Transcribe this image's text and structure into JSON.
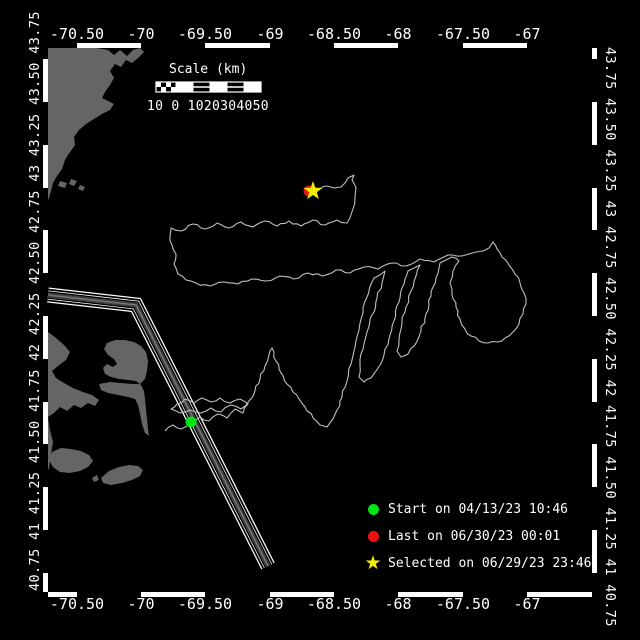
{
  "canvas": {
    "width": 640,
    "height": 640,
    "background": "#000000"
  },
  "axes": {
    "lon_labels": [
      "-70.50",
      "-70",
      "-69.50",
      "-69",
      "-68.50",
      "-68",
      "-67.50",
      "-67"
    ],
    "lon_tick_x": [
      77,
      141,
      205,
      270,
      334,
      398,
      463,
      527
    ],
    "lat_tick_y": [
      59,
      102,
      145,
      188,
      230,
      273,
      316,
      359,
      402,
      444,
      487,
      530,
      573
    ],
    "lat_left_text": "40.75 41 41.25 41.50 41.75 42 42.25 42.50 42.75 43 43.25 43.50 43.75",
    "lat_right_text": "43.75 43.50 43.25 43 42.75 42.50 42.25 42 41.75 41.50 41.25 41 40.75",
    "frame": {
      "left": 48,
      "top": 48,
      "right": 592,
      "bottom": 592,
      "band": 5,
      "color": "#ffffff"
    }
  },
  "scalebar": {
    "title": "Scale (km)",
    "tick_text": "10 0 1020304050",
    "x": 156,
    "y": 82,
    "width": 105,
    "height": 10,
    "check_cols": 4,
    "check_rows": 2,
    "cells": 5
  },
  "legend": {
    "items": [
      {
        "marker": "circle",
        "color": "#00e412",
        "label": "Start on 04/13/23 10:46"
      },
      {
        "marker": "circle",
        "color": "#ee1111",
        "label": "Last on 06/30/23 00:01"
      },
      {
        "marker": "star",
        "color": "#f5ef00",
        "glyph": "★",
        "label": "Selected on 06/29/23 23:46"
      }
    ]
  },
  "map_data": {
    "colors": {
      "land": "#656565",
      "track": "#bfbfbf",
      "frame": "#ffffff",
      "lane_edge": "#ffffff",
      "lane_core": "#3f3f3f",
      "lane_center": "#757575",
      "start": "#00e412",
      "last": "#ee1111",
      "selected": "#f5ef00"
    },
    "markers": {
      "start": {
        "x": 191,
        "y": 422,
        "r": 5.5
      },
      "last": {
        "x": 309,
        "y": 191,
        "r": 5.5
      },
      "selected": {
        "x": 313,
        "y": 191,
        "r_outer": 10,
        "r_inner": 4
      }
    },
    "lane": [
      [
        48,
        295
      ],
      [
        136,
        305
      ],
      [
        268,
        566
      ]
    ],
    "land": [
      [
        [
          48,
          48
        ],
        [
          96,
          48
        ],
        [
          108,
          50
        ],
        [
          114,
          55
        ],
        [
          120,
          50
        ],
        [
          127,
          56
        ],
        [
          133,
          50
        ],
        [
          140,
          48
        ],
        [
          144,
          52
        ],
        [
          138,
          58
        ],
        [
          132,
          63
        ],
        [
          126,
          60
        ],
        [
          121,
          67
        ],
        [
          115,
          64
        ],
        [
          110,
          71
        ],
        [
          114,
          78
        ],
        [
          110,
          85
        ],
        [
          105,
          92
        ],
        [
          102,
          98
        ],
        [
          108,
          101
        ],
        [
          114,
          104
        ],
        [
          110,
          110
        ],
        [
          102,
          114
        ],
        [
          94,
          119
        ],
        [
          86,
          124
        ],
        [
          79,
          130
        ],
        [
          74,
          137
        ],
        [
          75,
          145
        ],
        [
          70,
          152
        ],
        [
          65,
          160
        ],
        [
          62,
          169
        ],
        [
          57,
          176
        ],
        [
          53,
          183
        ],
        [
          51,
          191
        ],
        [
          49,
          198
        ],
        [
          48,
          200
        ]
      ],
      [
        [
          60,
          181
        ],
        [
          67,
          183
        ],
        [
          65,
          188
        ],
        [
          58,
          186
        ]
      ],
      [
        [
          71,
          179
        ],
        [
          77,
          181
        ],
        [
          74,
          186
        ],
        [
          69,
          184
        ]
      ],
      [
        [
          80,
          185
        ],
        [
          85,
          187
        ],
        [
          83,
          191
        ],
        [
          78,
          189
        ]
      ],
      [
        [
          48,
          332
        ],
        [
          56,
          338
        ],
        [
          64,
          345
        ],
        [
          70,
          352
        ],
        [
          66,
          360
        ],
        [
          58,
          366
        ],
        [
          52,
          371
        ],
        [
          56,
          378
        ],
        [
          64,
          383
        ],
        [
          73,
          388
        ],
        [
          83,
          392
        ],
        [
          92,
          395
        ],
        [
          99,
          400
        ],
        [
          95,
          406
        ],
        [
          88,
          403
        ],
        [
          81,
          408
        ],
        [
          74,
          405
        ],
        [
          67,
          411
        ],
        [
          60,
          407
        ],
        [
          54,
          413
        ],
        [
          48,
          417
        ],
        [
          50,
          430
        ],
        [
          53,
          442
        ],
        [
          51,
          455
        ],
        [
          49,
          468
        ],
        [
          48,
          470
        ]
      ],
      [
        [
          99,
          384
        ],
        [
          110,
          382
        ],
        [
          121,
          383
        ],
        [
          132,
          384
        ],
        [
          140,
          384
        ],
        [
          145,
          379
        ],
        [
          147,
          371
        ],
        [
          148,
          361
        ],
        [
          146,
          352
        ],
        [
          141,
          346
        ],
        [
          134,
          342
        ],
        [
          125,
          340
        ],
        [
          115,
          340
        ],
        [
          107,
          343
        ],
        [
          104,
          349
        ],
        [
          108,
          355
        ],
        [
          114,
          359
        ],
        [
          117,
          364
        ],
        [
          113,
          367
        ],
        [
          107,
          364
        ],
        [
          103,
          368
        ],
        [
          105,
          374
        ],
        [
          111,
          377
        ],
        [
          119,
          379
        ],
        [
          128,
          380
        ],
        [
          136,
          381
        ],
        [
          141,
          385
        ],
        [
          144,
          391
        ],
        [
          145,
          399
        ],
        [
          146,
          409
        ],
        [
          147,
          419
        ],
        [
          148,
          429
        ],
        [
          149,
          436
        ],
        [
          145,
          433
        ],
        [
          142,
          424
        ],
        [
          140,
          414
        ],
        [
          138,
          405
        ],
        [
          135,
          399
        ],
        [
          128,
          397
        ],
        [
          118,
          395
        ],
        [
          108,
          393
        ],
        [
          101,
          390
        ]
      ],
      [
        [
          52,
          452
        ],
        [
          61,
          448
        ],
        [
          71,
          449
        ],
        [
          81,
          451
        ],
        [
          89,
          455
        ],
        [
          93,
          461
        ],
        [
          88,
          467
        ],
        [
          80,
          471
        ],
        [
          70,
          473
        ],
        [
          60,
          472
        ],
        [
          53,
          467
        ],
        [
          49,
          460
        ]
      ],
      [
        [
          101,
          478
        ],
        [
          109,
          471
        ],
        [
          119,
          467
        ],
        [
          129,
          465
        ],
        [
          138,
          466
        ],
        [
          143,
          470
        ],
        [
          140,
          476
        ],
        [
          132,
          480
        ],
        [
          122,
          483
        ],
        [
          111,
          485
        ],
        [
          103,
          483
        ]
      ],
      [
        [
          92,
          478
        ],
        [
          97,
          475
        ],
        [
          99,
          480
        ],
        [
          94,
          482
        ]
      ]
    ],
    "track": [
      [
        165,
        431
      ],
      [
        173,
        425
      ],
      [
        181,
        429
      ],
      [
        191,
        422
      ],
      [
        200,
        417
      ],
      [
        209,
        421
      ],
      [
        218,
        414
      ],
      [
        227,
        418
      ],
      [
        235,
        409
      ],
      [
        243,
        413
      ],
      [
        248,
        404
      ],
      [
        240,
        399
      ],
      [
        230,
        403
      ],
      [
        220,
        398
      ],
      [
        211,
        402
      ],
      [
        202,
        398
      ],
      [
        194,
        403
      ],
      [
        185,
        399
      ],
      [
        177,
        404
      ],
      [
        171,
        409
      ],
      [
        180,
        413
      ],
      [
        190,
        410
      ],
      [
        201,
        413
      ],
      [
        211,
        408
      ],
      [
        221,
        412
      ],
      [
        231,
        405
      ],
      [
        241,
        409
      ],
      [
        249,
        401
      ],
      [
        255,
        391
      ],
      [
        260,
        379
      ],
      [
        265,
        366
      ],
      [
        269,
        355
      ],
      [
        272,
        348
      ],
      [
        276,
        361
      ],
      [
        281,
        373
      ],
      [
        287,
        384
      ],
      [
        293,
        392
      ],
      [
        299,
        399
      ],
      [
        305,
        407
      ],
      [
        313,
        418
      ],
      [
        320,
        425
      ],
      [
        327,
        427
      ],
      [
        333,
        419
      ],
      [
        337,
        410
      ],
      [
        342,
        397
      ],
      [
        347,
        381
      ],
      [
        351,
        364
      ],
      [
        355,
        347
      ],
      [
        359,
        330
      ],
      [
        363,
        313
      ],
      [
        367,
        297
      ],
      [
        371,
        284
      ],
      [
        374,
        278
      ],
      [
        380,
        275
      ],
      [
        385,
        271
      ],
      [
        382,
        283
      ],
      [
        377,
        298
      ],
      [
        372,
        315
      ],
      [
        367,
        332
      ],
      [
        363,
        349
      ],
      [
        360,
        365
      ],
      [
        359,
        377
      ],
      [
        364,
        382
      ],
      [
        371,
        378
      ],
      [
        378,
        368
      ],
      [
        384,
        355
      ],
      [
        389,
        339
      ],
      [
        394,
        321
      ],
      [
        399,
        302
      ],
      [
        404,
        284
      ],
      [
        408,
        271
      ],
      [
        414,
        268
      ],
      [
        420,
        265
      ],
      [
        416,
        276
      ],
      [
        411,
        291
      ],
      [
        406,
        307
      ],
      [
        402,
        323
      ],
      [
        399,
        339
      ],
      [
        397,
        351
      ],
      [
        401,
        357
      ],
      [
        408,
        354
      ],
      [
        415,
        345
      ],
      [
        421,
        331
      ],
      [
        426,
        314
      ],
      [
        431,
        296
      ],
      [
        436,
        278
      ],
      [
        440,
        263
      ],
      [
        446,
        260
      ],
      [
        452,
        257
      ],
      [
        459,
        261
      ],
      [
        453,
        271
      ],
      [
        450,
        283
      ],
      [
        452,
        295
      ],
      [
        456,
        307
      ],
      [
        460,
        319
      ],
      [
        465,
        329
      ],
      [
        471,
        336
      ],
      [
        479,
        341
      ],
      [
        488,
        343
      ],
      [
        497,
        342
      ],
      [
        505,
        338
      ],
      [
        513,
        332
      ],
      [
        519,
        324
      ],
      [
        523,
        314
      ],
      [
        526,
        304
      ],
      [
        524,
        293
      ],
      [
        520,
        283
      ],
      [
        515,
        274
      ],
      [
        509,
        265
      ],
      [
        502,
        257
      ],
      [
        497,
        249
      ],
      [
        493,
        242
      ],
      [
        489,
        248
      ],
      [
        483,
        251
      ],
      [
        476,
        252
      ],
      [
        469,
        254
      ],
      [
        462,
        256
      ],
      [
        448,
        255
      ],
      [
        434,
        262
      ],
      [
        420,
        259
      ],
      [
        406,
        266
      ],
      [
        392,
        263
      ],
      [
        378,
        269
      ],
      [
        364,
        267
      ],
      [
        350,
        273
      ],
      [
        336,
        270
      ],
      [
        322,
        276
      ],
      [
        308,
        273
      ],
      [
        294,
        279
      ],
      [
        280,
        276
      ],
      [
        266,
        281
      ],
      [
        252,
        279
      ],
      [
        238,
        284
      ],
      [
        224,
        282
      ],
      [
        210,
        286
      ],
      [
        196,
        283
      ],
      [
        186,
        280
      ],
      [
        178,
        274
      ],
      [
        174,
        264
      ],
      [
        176,
        254
      ],
      [
        172,
        245
      ],
      [
        170,
        236
      ],
      [
        171,
        228
      ],
      [
        181,
        231
      ],
      [
        193,
        224
      ],
      [
        205,
        229
      ],
      [
        217,
        223
      ],
      [
        229,
        228
      ],
      [
        241,
        222
      ],
      [
        253,
        227
      ],
      [
        265,
        221
      ],
      [
        277,
        226
      ],
      [
        289,
        221
      ],
      [
        301,
        226
      ],
      [
        313,
        220
      ],
      [
        325,
        225
      ],
      [
        337,
        220
      ],
      [
        347,
        223
      ],
      [
        350,
        218
      ],
      [
        353,
        209
      ],
      [
        355,
        198
      ],
      [
        356,
        188
      ],
      [
        352,
        180
      ],
      [
        354,
        175
      ],
      [
        348,
        178
      ],
      [
        341,
        187
      ],
      [
        334,
        188
      ],
      [
        327,
        186
      ],
      [
        320,
        189
      ],
      [
        313,
        191
      ]
    ]
  }
}
